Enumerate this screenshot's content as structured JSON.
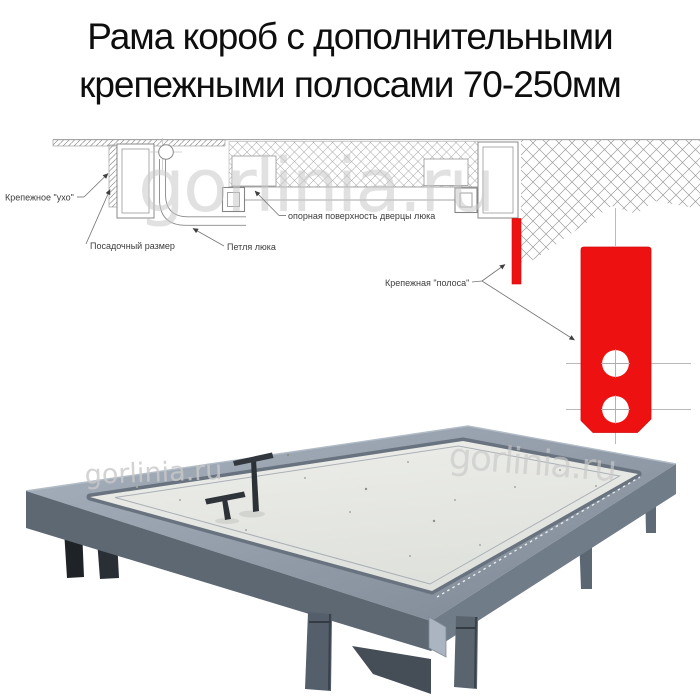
{
  "title": {
    "line1": "Рама короб с дополнительными",
    "line2": "крепежными полосами 70-250мм"
  },
  "watermark": {
    "text": "gorlinia.ru"
  },
  "diagram": {
    "labels": {
      "ear": "Крепежное \"ухо\"",
      "mount": "Посадочный размер",
      "hinge": "Петля люка",
      "support": "опорная поверхность дверцы люка",
      "strip": "Крепежная \"полоса\""
    },
    "colors": {
      "highlight_red": "#ee1111",
      "line_gray": "#8a8a8a"
    }
  },
  "photo": {
    "colors": {
      "frame_metal": "#6e7985",
      "panel": "#e9eae6",
      "handles": "#2f343a"
    }
  }
}
